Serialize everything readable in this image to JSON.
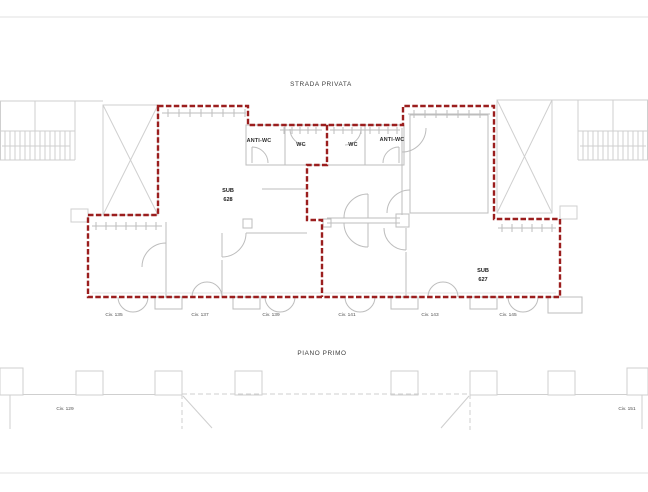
{
  "colors": {
    "boundary_red": "#9b1e1e",
    "wall_gray": "#bdbdbd",
    "wall_light": "#cfcfcf",
    "sheet_line": "#e2e2e2"
  },
  "header": {
    "street_label": "STRADA PRIVATA"
  },
  "plan": {
    "rooms": [
      {
        "label": "ANTI-WC"
      },
      {
        "label": "WC"
      },
      {
        "label": "WC"
      },
      {
        "label": "ANTI-WC"
      }
    ],
    "units": [
      {
        "line1": "SUB",
        "line2": "628"
      },
      {
        "line1": "SUB",
        "line2": "627"
      }
    ],
    "civic_numbers": [
      "Civ. 135",
      "Civ. 137",
      "Civ. 139",
      "Civ. 141",
      "Civ. 143",
      "Civ. 145"
    ]
  },
  "footer": {
    "floor_label": "PIANO PRIMO",
    "civic_left": "Civ. 129",
    "civic_right": "Civ. 151"
  }
}
